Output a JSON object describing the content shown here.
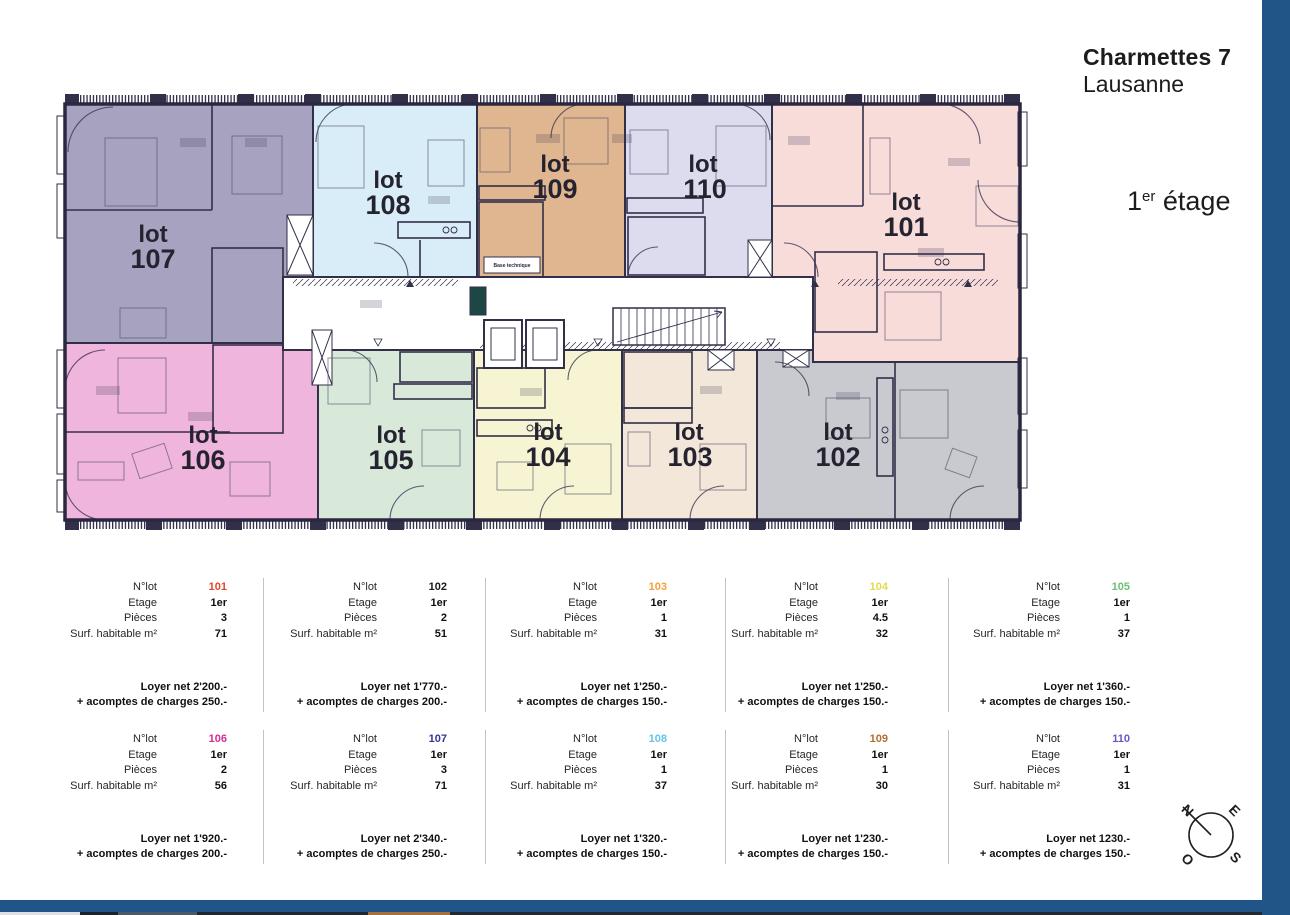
{
  "header": {
    "title": "Charmettes 7",
    "subtitle": "Lausanne"
  },
  "floor": {
    "number": "1",
    "ordinal": "er",
    "word": "étage"
  },
  "plan": {
    "lot_word": "lot",
    "base_technique": "Base technique",
    "lots": [
      {
        "num": "101",
        "fill": "#f8dcda"
      },
      {
        "num": "102",
        "fill": "#c9c9d0"
      },
      {
        "num": "103",
        "fill": "#f3e7da"
      },
      {
        "num": "104",
        "fill": "#f6f4d2"
      },
      {
        "num": "105",
        "fill": "#d8e9da"
      },
      {
        "num": "106",
        "fill": "#efb5dc"
      },
      {
        "num": "107",
        "fill": "#a7a2c0"
      },
      {
        "num": "108",
        "fill": "#d9edf8"
      },
      {
        "num": "109",
        "fill": "#dfb68f"
      },
      {
        "num": "110",
        "fill": "#dddcee"
      }
    ]
  },
  "tables": {
    "row_labels": [
      "N°lot",
      "Etage",
      "Pièces",
      "Surf. habitable m²"
    ],
    "cards": [
      {
        "lot": "101",
        "lot_color": "#e8432d",
        "etage": "1er",
        "pieces": "3",
        "surface": "71",
        "rent": "Loyer net 2'200.-",
        "charges": "+ acomptes de charges 250.-"
      },
      {
        "lot": "102",
        "lot_color": "#1a1a1a",
        "etage": "1er",
        "pieces": "2",
        "surface": "51",
        "rent": "Loyer net 1'770.-",
        "charges": "+ acomptes de charges 200.-"
      },
      {
        "lot": "103",
        "lot_color": "#f2a33c",
        "etage": "1er",
        "pieces": "1",
        "surface": "31",
        "rent": "Loyer net 1'250.-",
        "charges": "+ acomptes de charges 150.-"
      },
      {
        "lot": "104",
        "lot_color": "#e0da52",
        "etage": "1er",
        "pieces": "4.5",
        "surface": "32",
        "rent": "Loyer net 1'250.-",
        "charges": "+ acomptes de charges 150.-"
      },
      {
        "lot": "105",
        "lot_color": "#6cc071",
        "etage": "1er",
        "pieces": "1",
        "surface": "37",
        "rent": "Loyer net 1'360.-",
        "charges": "+ acomptes de charges 150.-"
      },
      {
        "lot": "106",
        "lot_color": "#d62d92",
        "etage": "1er",
        "pieces": "2",
        "surface": "56",
        "rent": "Loyer net 1'920.-",
        "charges": "+ acomptes de charges 200.-"
      },
      {
        "lot": "107",
        "lot_color": "#34359b",
        "etage": "1er",
        "pieces": "3",
        "surface": "71",
        "rent": "Loyer net 2'340.-",
        "charges": "+ acomptes de charges 250.-"
      },
      {
        "lot": "108",
        "lot_color": "#63c5ea",
        "etage": "1er",
        "pieces": "1",
        "surface": "37",
        "rent": "Loyer net 1'320.-",
        "charges": "+ acomptes de charges 150.-"
      },
      {
        "lot": "109",
        "lot_color": "#b26f33",
        "etage": "1er",
        "pieces": "1",
        "surface": "30",
        "rent": "Loyer net 1'230.-",
        "charges": "+ acomptes de charges 150.-"
      },
      {
        "lot": "110",
        "lot_color": "#6659c9",
        "etage": "1er",
        "pieces": "1",
        "surface": "31",
        "rent": "Loyer net 1230.-",
        "charges": "+ acomptes de charges 150.-"
      }
    ]
  },
  "compass": {
    "north": "N",
    "east": "E",
    "south": "S",
    "west": "O"
  },
  "footer": {
    "accent_bar": "#215487",
    "strip": [
      "#dfe0e3",
      "#1b242b",
      "#4b5a64",
      "#20282e",
      "#a5713f",
      "#23292e"
    ]
  }
}
